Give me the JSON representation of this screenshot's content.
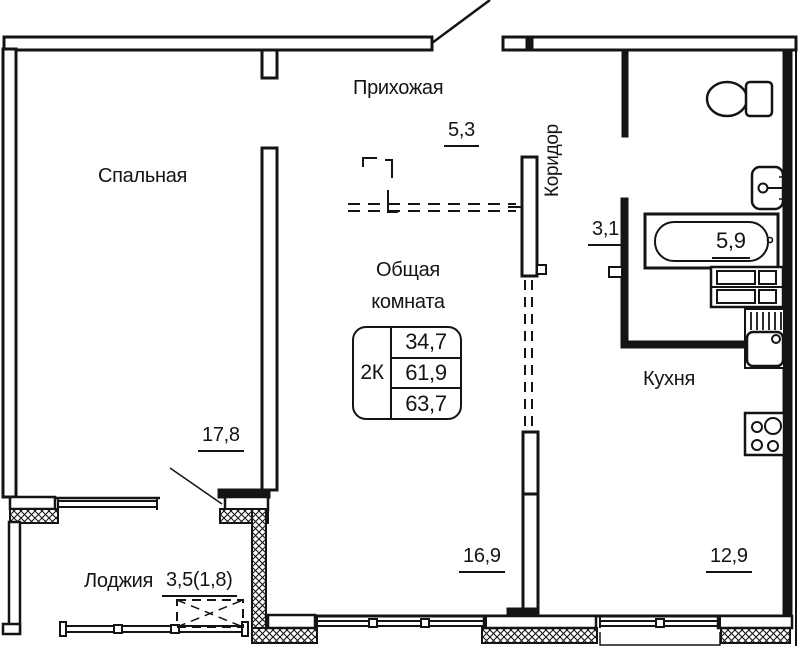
{
  "rooms": {
    "bedroom": {
      "label": "Спальная",
      "area": "17,8"
    },
    "hallway": {
      "label": "Прихожая",
      "area": "5,3"
    },
    "corridor": {
      "label": "Коридор",
      "area": "3,1"
    },
    "living_room": {
      "label": "Общая комната",
      "area": "16,9"
    },
    "kitchen": {
      "label": "Кухня",
      "area": "12,9"
    },
    "bathroom": {
      "area": "5,9"
    },
    "loggia": {
      "label": "Лоджия",
      "area": "3,5(1,8)"
    }
  },
  "summary_table": {
    "type": "2К",
    "rows": [
      "34,7",
      "61,9",
      "63,7"
    ]
  },
  "fixtures": [
    "toilet",
    "washbasin",
    "bathtub",
    "cabinet",
    "kitchen-sink",
    "stove"
  ],
  "colors": {
    "line": "#141414",
    "background": "#ffffff"
  }
}
